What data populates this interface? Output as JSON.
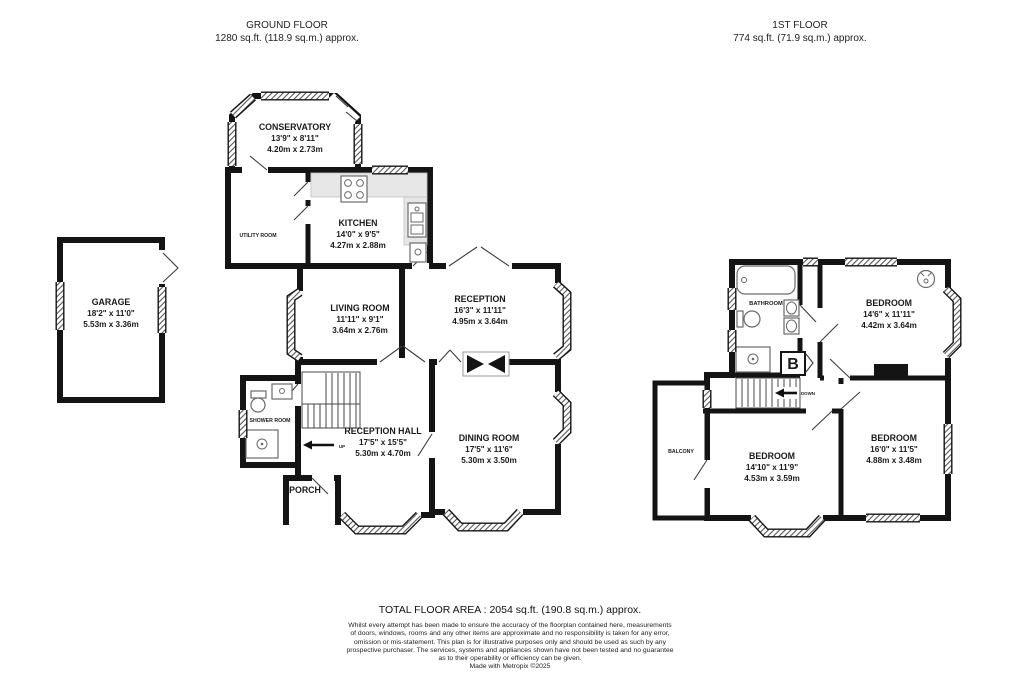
{
  "floors": {
    "ground": {
      "title": "GROUND FLOOR",
      "area": "1280 sq.ft. (118.9 sq.m.) approx."
    },
    "first": {
      "title": "1ST FLOOR",
      "area": "774 sq.ft. (71.9 sq.m.) approx."
    }
  },
  "rooms": {
    "garage": {
      "name": "GARAGE",
      "dim_ft": "18'2\" x 11'0\"",
      "dim_m": "5.53m x 3.36m"
    },
    "conservatory": {
      "name": "CONSERVATORY",
      "dim_ft": "13'9\" x 8'11\"",
      "dim_m": "4.20m x 2.73m"
    },
    "kitchen": {
      "name": "KITCHEN",
      "dim_ft": "14'0\" x 9'5\"",
      "dim_m": "4.27m x 2.88m"
    },
    "utility": {
      "name": "UTILITY ROOM"
    },
    "living": {
      "name": "LIVING ROOM",
      "dim_ft": "11'11\" x 9'1\"",
      "dim_m": "3.64m x 2.76m"
    },
    "reception": {
      "name": "RECEPTION",
      "dim_ft": "16'3\" x 11'11\"",
      "dim_m": "4.95m x 3.64m"
    },
    "hall": {
      "name": "RECEPTION HALL",
      "dim_ft": "17'5\" x 15'5\"",
      "dim_m": "5.30m x 4.70m"
    },
    "dining": {
      "name": "DINING ROOM",
      "dim_ft": "17'5\" x 11'6\"",
      "dim_m": "5.30m x 3.50m"
    },
    "shower": {
      "name": "SHOWER ROOM"
    },
    "porch": {
      "name": "PORCH"
    },
    "bathroom": {
      "name": "BATHROOM"
    },
    "bedroom1": {
      "name": "BEDROOM",
      "dim_ft": "14'6\" x 11'11\"",
      "dim_m": "4.42m x 3.64m"
    },
    "bedroom2": {
      "name": "BEDROOM",
      "dim_ft": "14'10\" x 11'9\"",
      "dim_m": "4.53m x 3.59m"
    },
    "bedroom3": {
      "name": "BEDROOM",
      "dim_ft": "16'0\" x 11'5\"",
      "dim_m": "4.88m x 3.48m"
    },
    "balcony": {
      "name": "BALCONY"
    }
  },
  "markers": {
    "up": "UP",
    "down": "DOWN",
    "boiler": "B"
  },
  "footer": {
    "total": "TOTAL FLOOR AREA : 2054 sq.ft. (190.8 sq.m.) approx.",
    "disclaimer": [
      "Whilst every attempt has been made to ensure the accuracy of the floorplan contained here, measurements",
      "of doors, windows, rooms and any other items are approximate and no responsibility is taken for any error,",
      "omission or mis-statement. This plan is for illustrative purposes only and should be used as such by any",
      "prospective purchaser. The services, systems and appliances shown have not been tested and no guarantee",
      "as to their operability or efficiency can be given."
    ],
    "credit": "Made with Metropix ©2025"
  }
}
